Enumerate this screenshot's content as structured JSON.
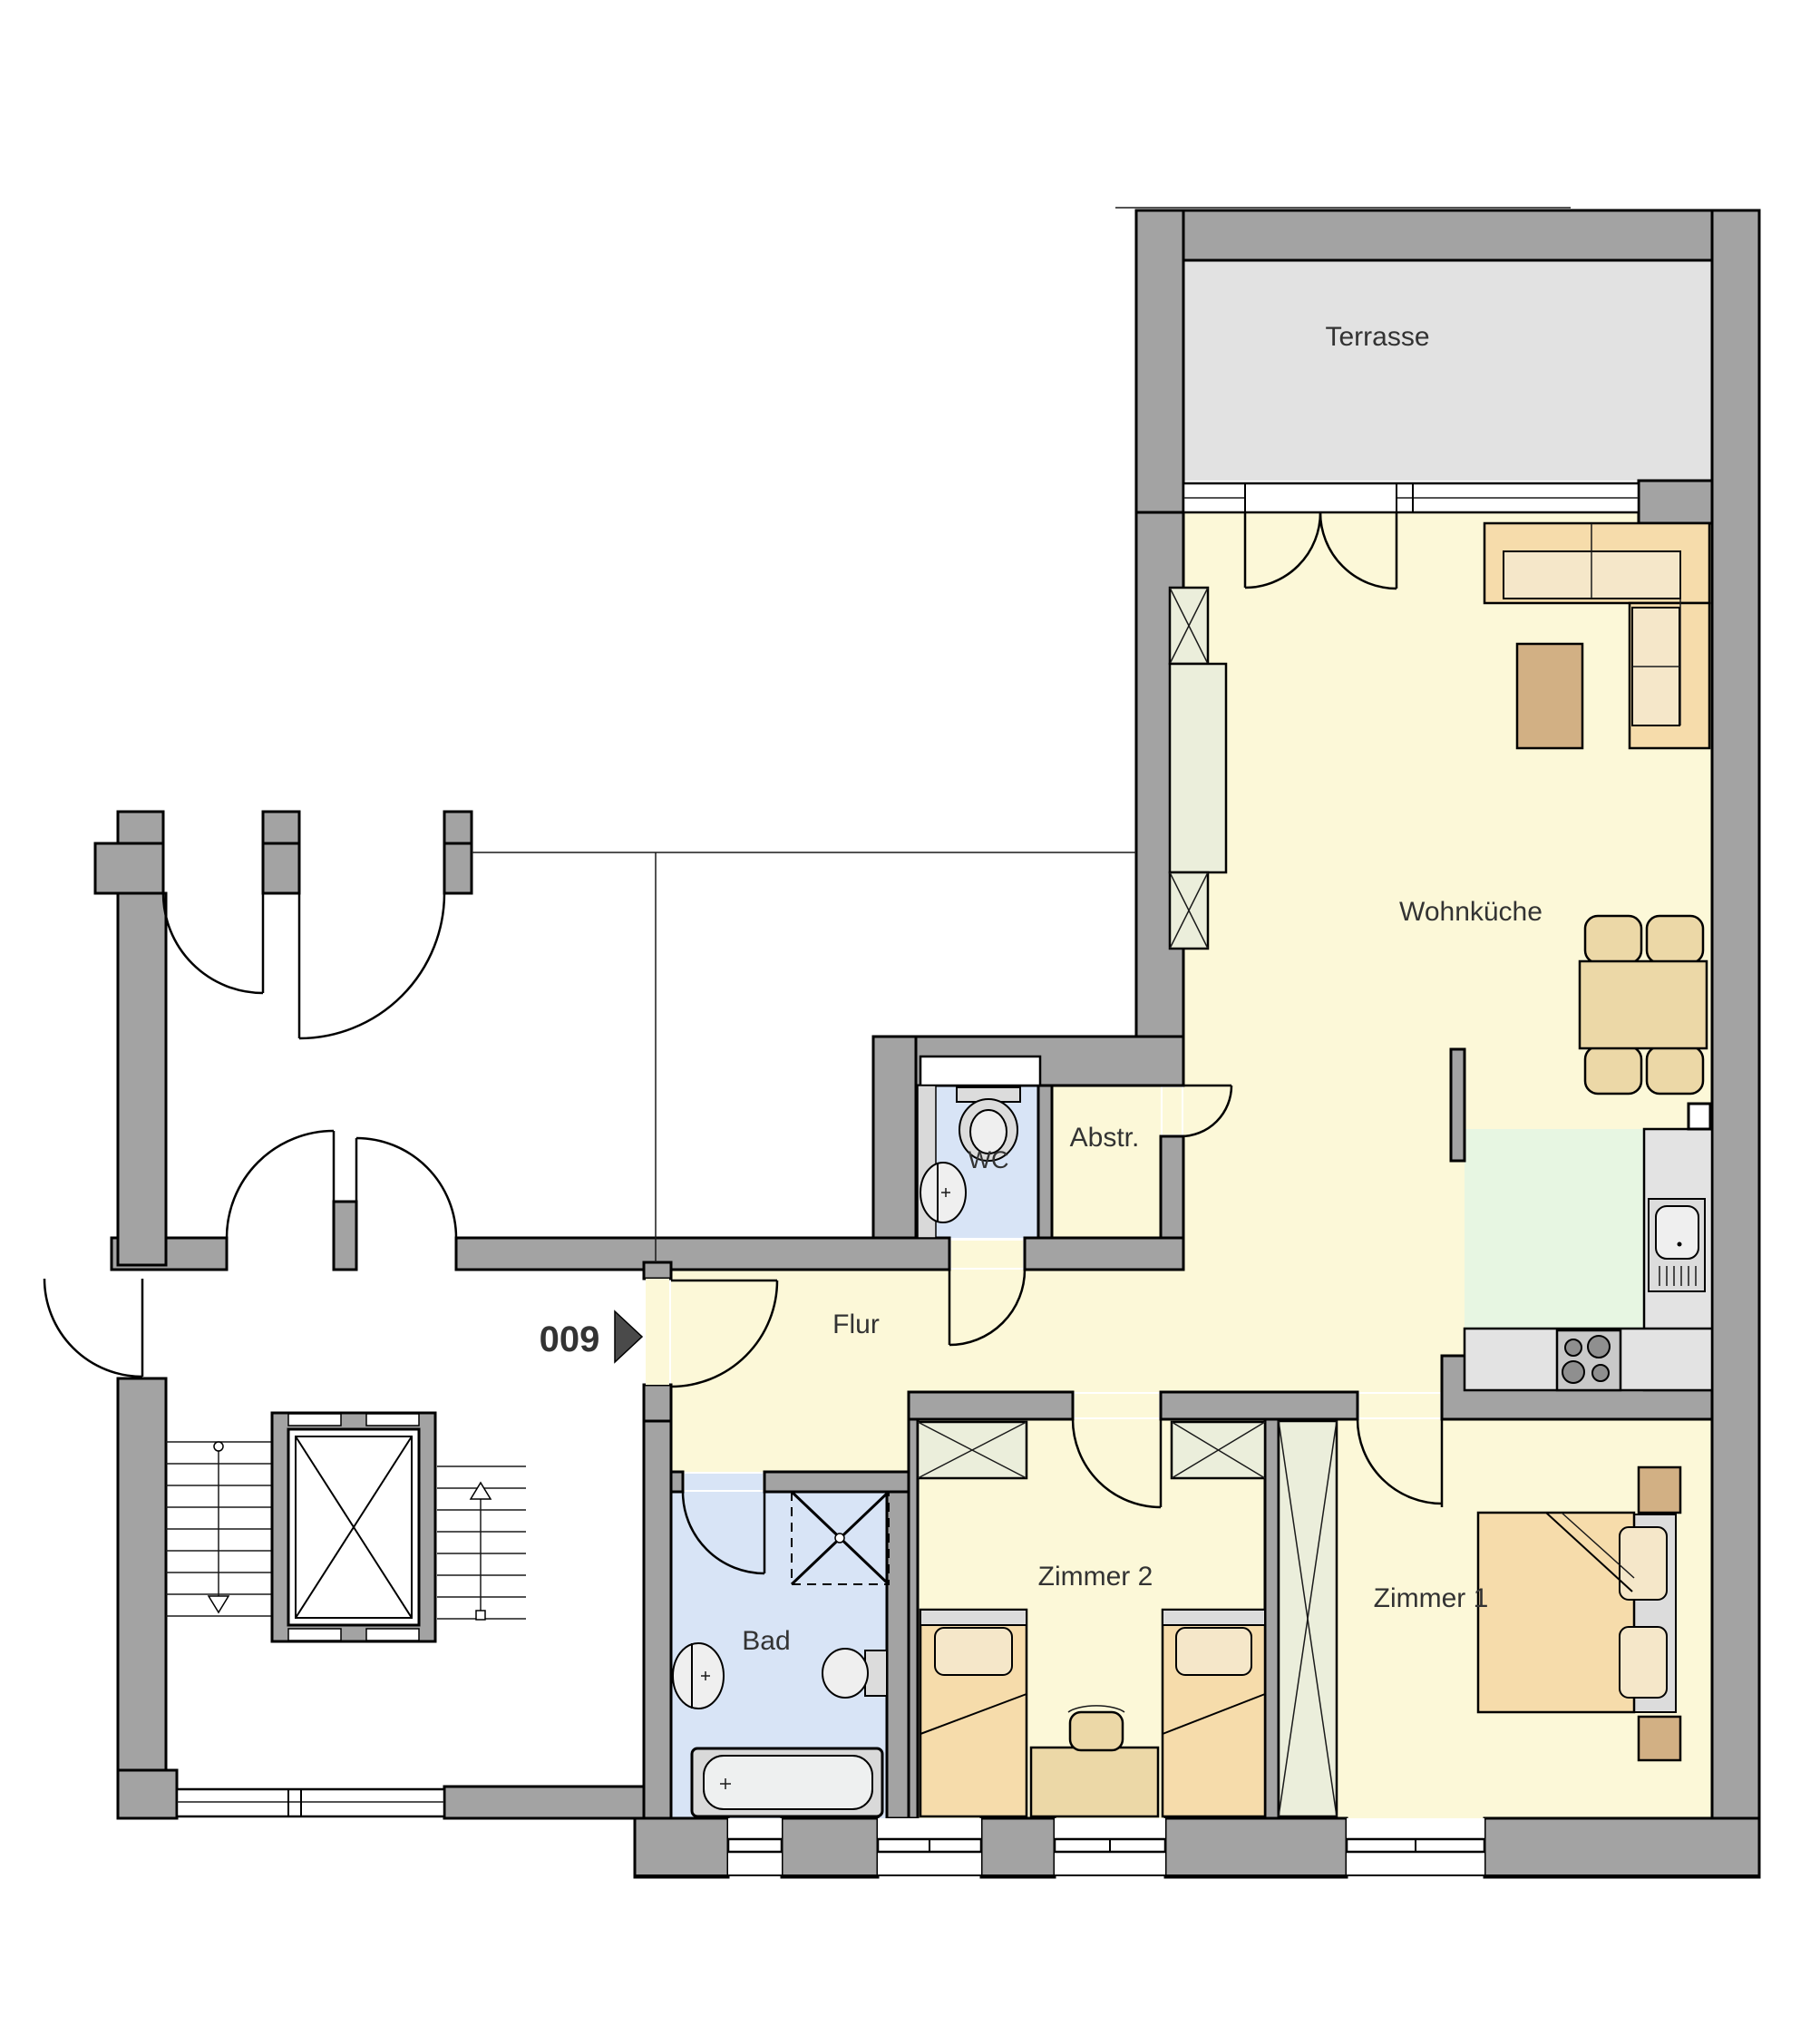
{
  "plan": {
    "unit_number": "009",
    "rooms": {
      "terrasse": {
        "label": "Terrasse"
      },
      "wohnkueche": {
        "label": "Wohnküche"
      },
      "abstellraum": {
        "label": "Abstr."
      },
      "wc": {
        "label": "WC"
      },
      "flur": {
        "label": "Flur"
      },
      "bad": {
        "label": "Bad"
      },
      "zimmer2": {
        "label": "Zimmer 2"
      },
      "zimmer1": {
        "label": "Zimmer 1"
      }
    },
    "colors": {
      "wall": "#a3a3a3",
      "room_yellow": "#fcf8d8",
      "terrace_gray": "#e2e2e2",
      "bath_blue": "#d8e4f6",
      "kitchen_green": "#e7f6e2",
      "furniture_tan": "#f6dcab",
      "pillow": "#f5e7c9",
      "table_tan": "#ecd8a7",
      "table_brown": "#d2b084",
      "cabinet_pale": "#ebeedb",
      "counter_gray": "#e3e3e3",
      "fixture_gray": "#dcdcdc",
      "label_color": "#333333",
      "arrow_gray": "#4a4a4a"
    }
  }
}
